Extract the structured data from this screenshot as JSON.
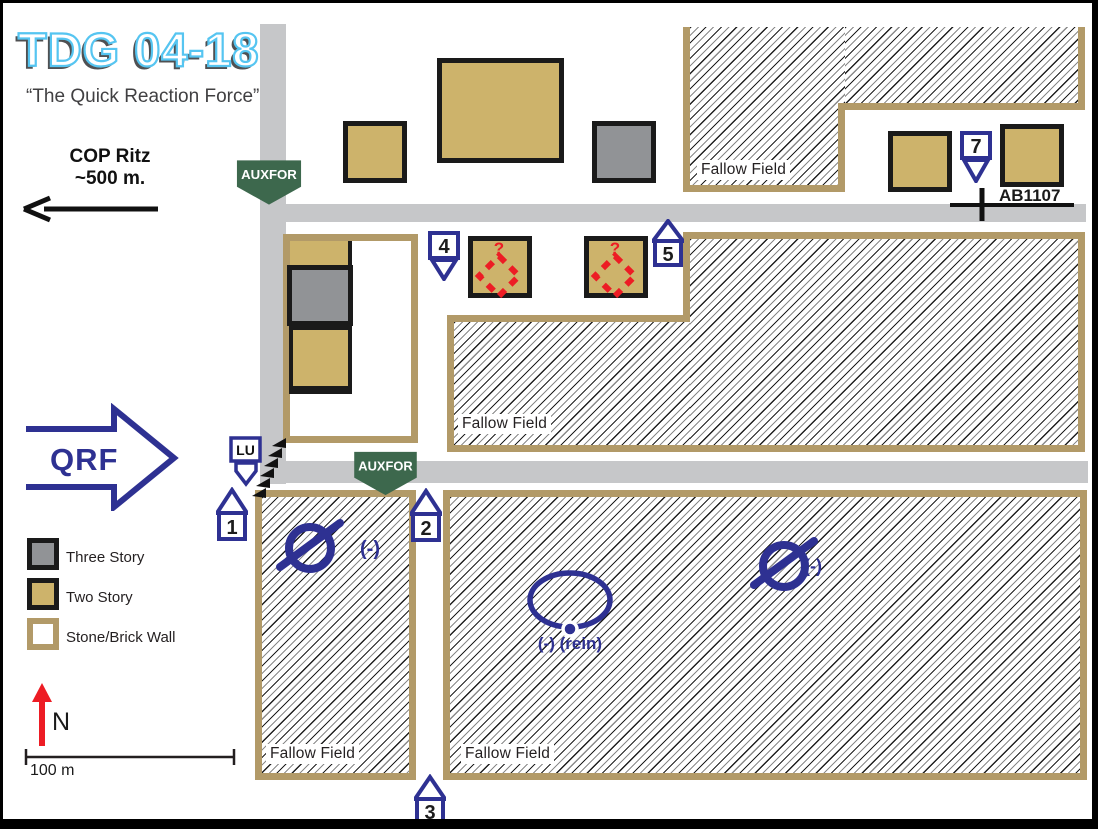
{
  "title": {
    "main": "TDG 04-18",
    "subtitle": "“The Quick Reaction Force”"
  },
  "annotations": {
    "cop_line1": "COP Ritz",
    "cop_line2": "~500 m.",
    "qrf": "QRF",
    "ab_marker": "AB1107",
    "north": "N",
    "scale": "100 m"
  },
  "signs": {
    "auxfor_top": "AUXFOR",
    "auxfor_bottom": "AUXFOR",
    "lu": "LU"
  },
  "route_markers": {
    "m1": "1",
    "m2": "2",
    "m3": "3",
    "m4": "4",
    "m5": "5",
    "m7": "7"
  },
  "fields": {
    "top_right": "Fallow Field",
    "middle": "Fallow Field",
    "bottom_left": "Fallow Field",
    "bottom_right": "Fallow Field"
  },
  "tactical": {
    "squad_left_mod": "(-)",
    "squad_right_mod": "(-)",
    "oval_mod": "(-) (rein)",
    "suspect_q1": "?",
    "suspect_q2": "?"
  },
  "legend": {
    "three_story": "Three Story",
    "two_story": "Two Story",
    "stone_wall": "Stone/Brick Wall"
  },
  "colors": {
    "two_story_fill": "#cdb36b",
    "three_story_fill": "#919396",
    "wall_border": "#b29a68",
    "road": "#c6c7c9",
    "unit_blue": "#2e3192",
    "auxfor_green": "#3d684d",
    "enemy_red": "#ed1c24",
    "title_blue": "#56c5f1"
  }
}
